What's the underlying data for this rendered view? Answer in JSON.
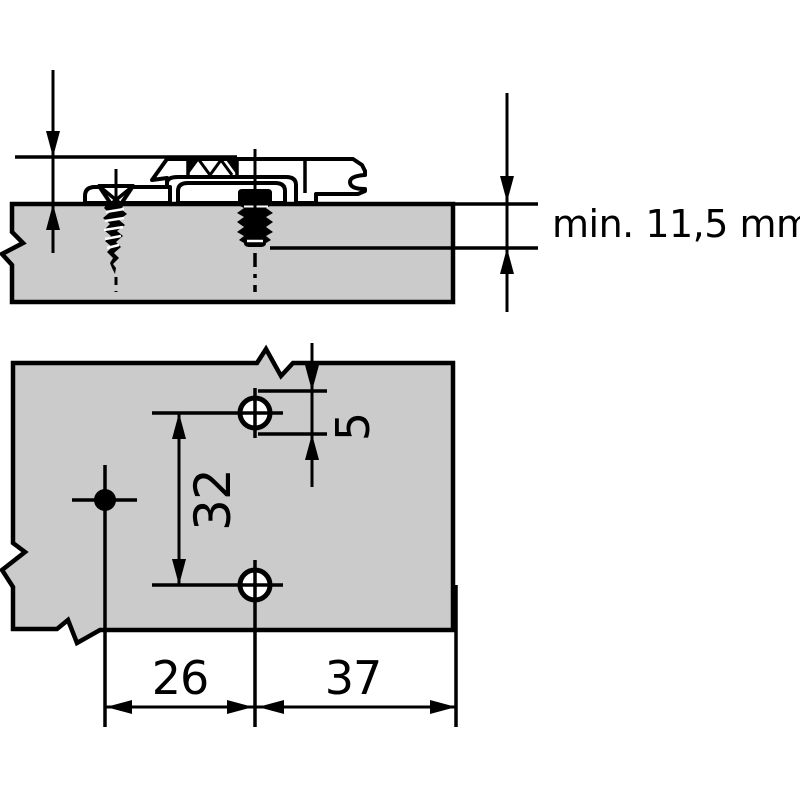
{
  "drawing": {
    "description": "technical installation drawing of a hinge mounting plate",
    "colors": {
      "line": "#000000",
      "panel_fill": "#cbcbcb",
      "background": "#ffffff"
    },
    "section_view": {
      "label_min_thickness": "min. 11,5 mm"
    },
    "plan_view": {
      "dim_vertical_slot": "5",
      "dim_hole_pitch": "32",
      "dim_dowel_to_holes": "26",
      "dim_holes_to_edge": "37"
    }
  }
}
